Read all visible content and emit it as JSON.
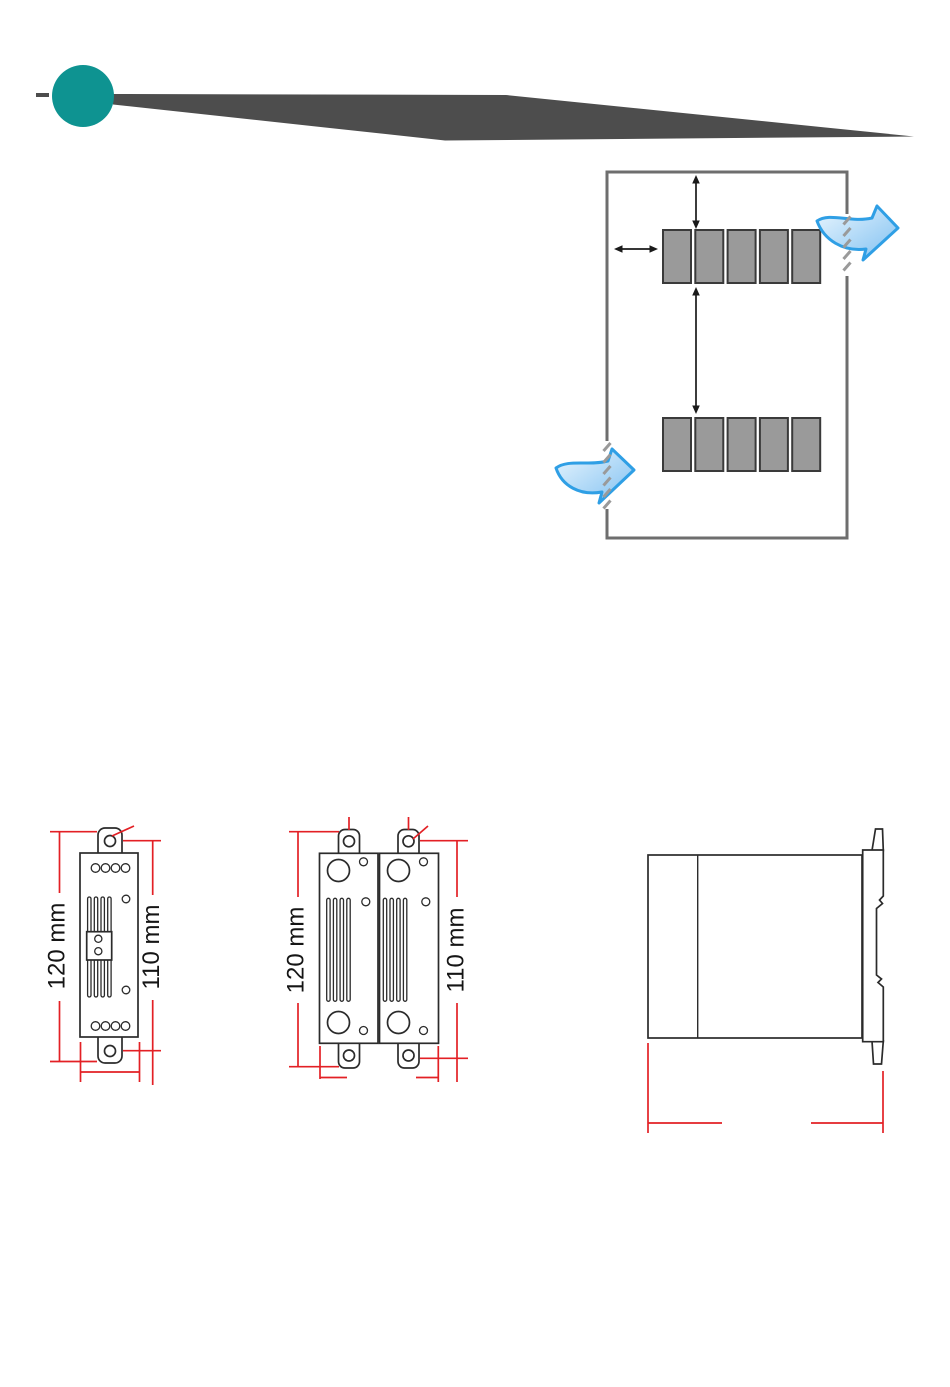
{
  "page": {
    "background": "#ffffff"
  },
  "header": {
    "dot_color": "#0e9391",
    "swoosh_color": "#4d4d4d"
  },
  "airflow_diagram": {
    "enclosure_border_color": "#6e6e6e",
    "module_fill": "#9a9a9a",
    "module_border": "#3a3a3a",
    "modules_per_row": 5,
    "row_count": 2,
    "vent_dash_color": "#9a9a9a",
    "airflow_arrow_fill_light": "#eaf6fe",
    "airflow_arrow_fill_dark": "#7fc0f1",
    "airflow_arrow_stroke": "#2f9fe5",
    "clearance_arrow_color": "#1a1a1a"
  },
  "dimension_drawings": {
    "dimension_line_color": "#e32025",
    "outline_color": "#2b2b2b",
    "single_unit": {
      "overall_height": "120 mm",
      "mounting_hole_span": "110 mm"
    },
    "paired_units": {
      "overall_height": "120 mm",
      "mounting_hole_span": "110 mm"
    }
  }
}
